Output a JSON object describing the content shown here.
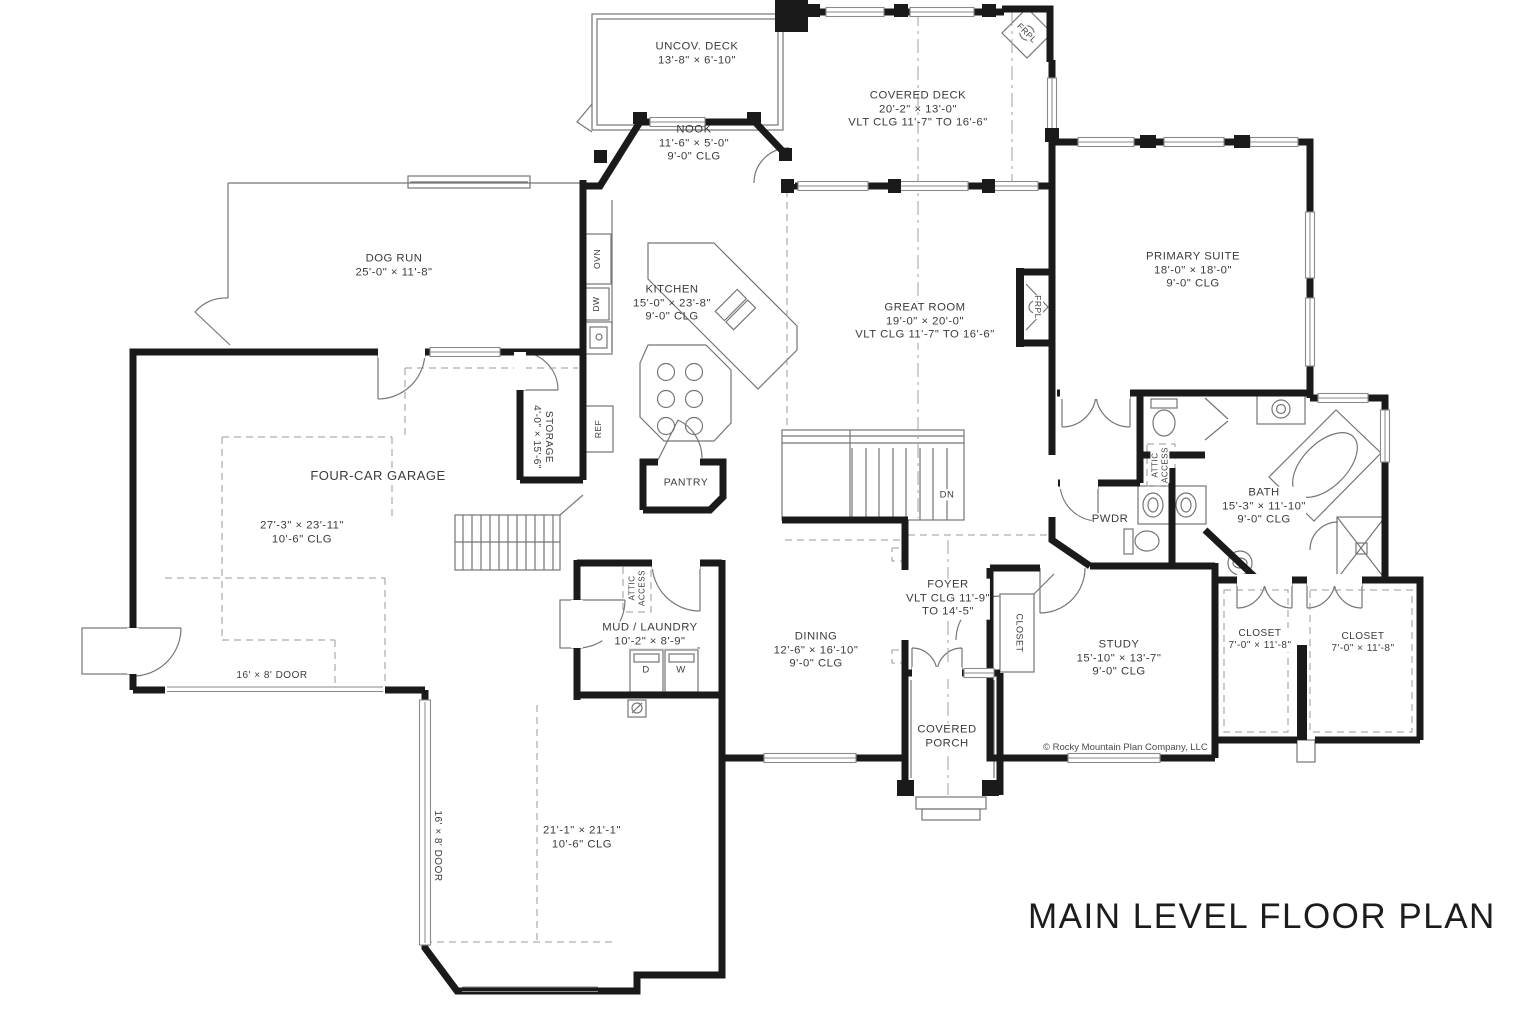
{
  "meta": {
    "title": "MAIN LEVEL FLOOR PLAN",
    "copyright": "© Rocky Mountain Plan Company, LLC"
  },
  "labels": [
    {
      "id": "room-uncov-deck",
      "text": "UNCOV. DECK\n13'-8\" × 6'-10\"",
      "x": 697,
      "y": 54
    },
    {
      "id": "room-covered-deck",
      "text": "COVERED DECK\n20'-2\" × 13'-0\"\nVLT CLG 11'-7\" TO 16'-6\"",
      "x": 918,
      "y": 110
    },
    {
      "id": "room-nook",
      "text": "NOOK\n11'-6\" × 5'-0\"\n9'-0\" CLG",
      "x": 694,
      "y": 144
    },
    {
      "id": "room-dog-run",
      "text": "DOG RUN\n25'-0\" × 11'-8\"",
      "x": 394,
      "y": 266
    },
    {
      "id": "room-kitchen",
      "text": "KITCHEN\n15'-0\" × 23'-8\"\n9'-0\" CLG",
      "x": 672,
      "y": 304
    },
    {
      "id": "room-great-room",
      "text": "GREAT ROOM\n19'-0\" × 20'-0\"\nVLT CLG 11'-7\" TO 16'-6\"",
      "x": 925,
      "y": 322,
      "bg": 1
    },
    {
      "id": "room-primary-suite",
      "text": "PRIMARY SUITE\n18'-0\" × 18'-0\"\n9'-0\" CLG",
      "x": 1193,
      "y": 271
    },
    {
      "id": "room-garage-name",
      "text": "FOUR-CAR GARAGE",
      "x": 378,
      "y": 476,
      "size": 13,
      "bg": 1
    },
    {
      "id": "room-garage-dims",
      "text": "27'-3\" × 23'-11\"\n10'-6\" CLG",
      "x": 302,
      "y": 533,
      "bg": 1
    },
    {
      "id": "room-storage",
      "text": "STORAGE\n4'-0\" × 15'-6\"",
      "x": 542,
      "y": 437,
      "rot": 90,
      "size": 10,
      "bg": 1
    },
    {
      "id": "room-pantry",
      "text": "PANTRY",
      "x": 686,
      "y": 483,
      "size": 10.5,
      "bg": 1
    },
    {
      "id": "room-bath",
      "text": "BATH\n15'-3\" × 11'-10\"\n9'-0\" CLG",
      "x": 1264,
      "y": 507,
      "bg": 1
    },
    {
      "id": "room-pwdr",
      "text": "PWDR",
      "x": 1110,
      "y": 520,
      "bg": 1
    },
    {
      "id": "room-study",
      "text": "STUDY\n15'-10\" × 13'-7\"\n9'-0\" CLG",
      "x": 1119,
      "y": 659
    },
    {
      "id": "room-closet-left",
      "text": "CLOSET\n7'-0\" × 11'-8\"",
      "x": 1260,
      "y": 640,
      "size": 10,
      "bg": 1
    },
    {
      "id": "room-closet-right",
      "text": "CLOSET\n7'-0\" × 11'-8\"",
      "x": 1363,
      "y": 643,
      "size": 10,
      "bg": 1
    },
    {
      "id": "room-mud-laundry",
      "text": "MUD / LAUNDRY\n10'-2\" × 8'-9\"",
      "x": 650,
      "y": 635,
      "bg": 1
    },
    {
      "id": "room-dining",
      "text": "DINING\n12'-6\" × 16'-10\"\n9'-0\" CLG",
      "x": 816,
      "y": 651
    },
    {
      "id": "room-foyer",
      "text": "FOYER\nVLT CLG 11'-9\"\nTO 14'-5\"",
      "x": 948,
      "y": 599,
      "bg": 1
    },
    {
      "id": "room-covered-porch",
      "text": "COVERED\nPORCH",
      "x": 947,
      "y": 737,
      "bg": 1
    },
    {
      "id": "room-garage2-dims",
      "text": "21'-1\" × 21'-1\"\n10'-6\" CLG",
      "x": 582,
      "y": 838
    },
    {
      "id": "label-garage2-door",
      "text": "16' × 8' DOOR",
      "x": 437,
      "y": 846,
      "rot": 90,
      "size": 10,
      "bg": 1
    },
    {
      "id": "label-garage-door",
      "text": "16' × 8' DOOR",
      "x": 272,
      "y": 676,
      "size": 10
    },
    {
      "id": "label-dn",
      "text": "DN",
      "x": 947,
      "y": 495,
      "size": 9.5,
      "bg": 1
    },
    {
      "id": "appliance-ovn",
      "text": "OVN",
      "x": 597,
      "y": 259,
      "rot": -90,
      "size": 8.5
    },
    {
      "id": "appliance-dw",
      "text": "DW",
      "x": 596,
      "y": 304,
      "rot": -90,
      "size": 8.5
    },
    {
      "id": "appliance-ref",
      "text": "REF",
      "x": 598,
      "y": 429,
      "rot": -90,
      "size": 8.5
    },
    {
      "id": "appliance-dryer",
      "text": "D",
      "x": 646,
      "y": 670,
      "size": 9.5
    },
    {
      "id": "appliance-washer",
      "text": "W",
      "x": 681,
      "y": 670,
      "size": 9.5
    },
    {
      "id": "label-frpl-deck",
      "text": "FRPL",
      "x": 1027,
      "y": 33,
      "rot": 45,
      "size": 8.5,
      "bg": 1
    },
    {
      "id": "label-frpl-great",
      "text": "FRPL",
      "x": 1038,
      "y": 307,
      "rot": 90,
      "size": 8.5,
      "bg": 1
    },
    {
      "id": "label-attic-access-mud",
      "text": "ATTIC\nACCESS",
      "x": 637,
      "y": 588,
      "rot": -90,
      "size": 8,
      "bg": 1
    },
    {
      "id": "label-attic-access-bath",
      "text": "ATTIC\nACCESS",
      "x": 1160,
      "y": 465,
      "rot": -90,
      "size": 8,
      "bg": 1
    },
    {
      "id": "label-closet-foyer",
      "text": "CLOSET",
      "x": 1019,
      "y": 633,
      "rot": 90,
      "size": 9,
      "bg": 1
    }
  ]
}
